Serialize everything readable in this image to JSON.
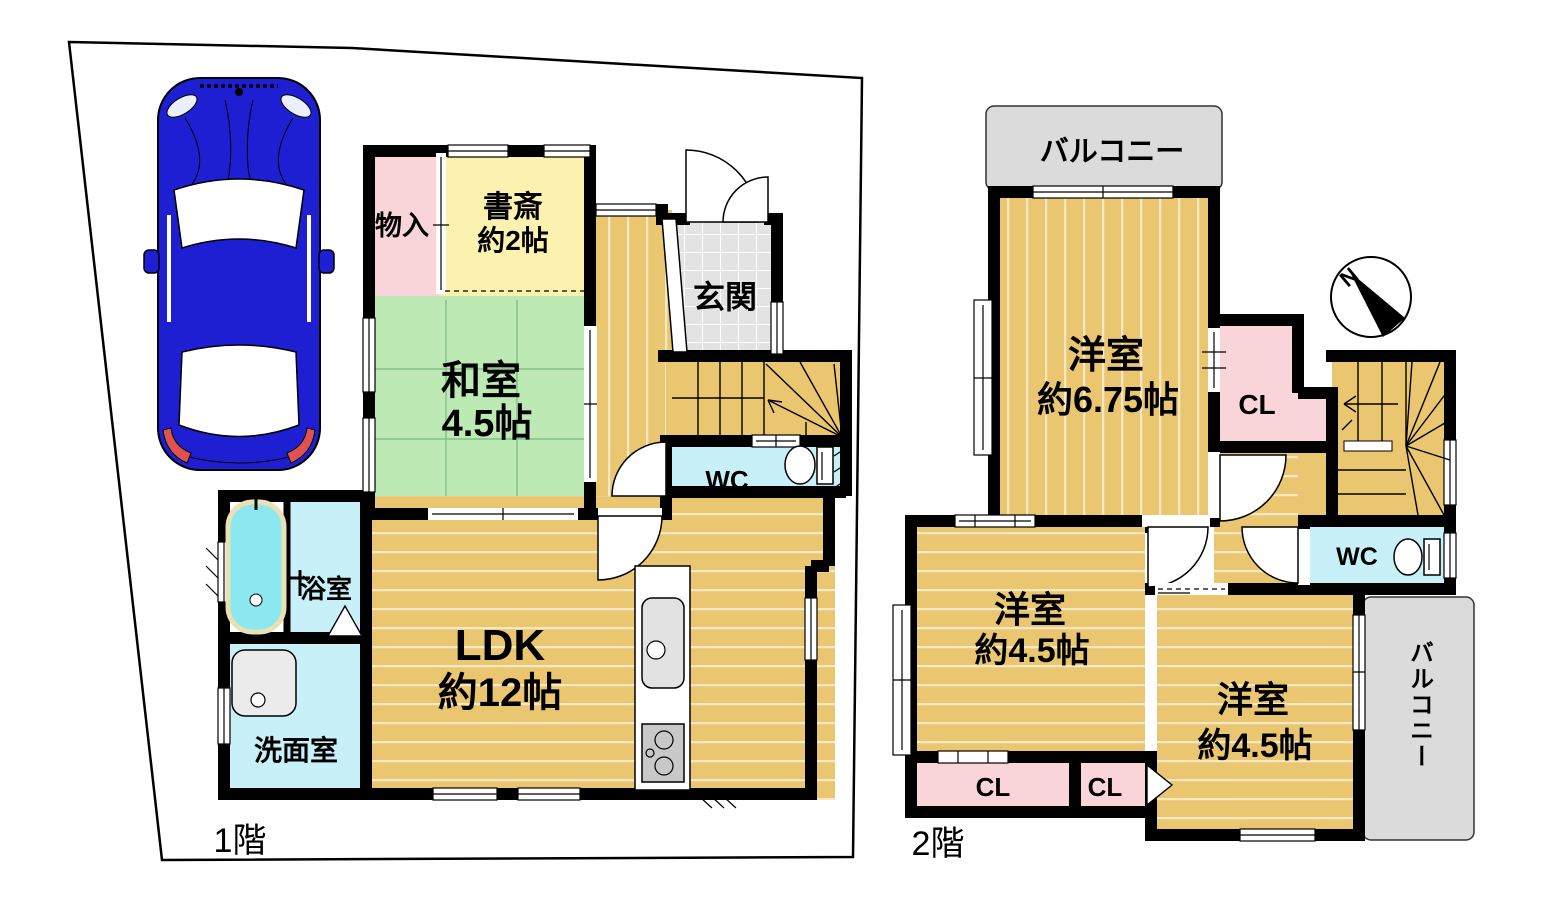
{
  "floor1": {
    "label": "1階",
    "rooms": {
      "storage": "物入",
      "study_name": "書斎",
      "study_size": "約2帖",
      "entrance": "玄関",
      "japanese_room_name": "和室",
      "japanese_room_size": "4.5帖",
      "wc": "WC",
      "bathroom": "浴室",
      "washroom": "洗面室",
      "ldk_name": "LDK",
      "ldk_size": "約12帖"
    }
  },
  "floor2": {
    "label": "2階",
    "rooms": {
      "balcony_top": "バルコニー",
      "western_675_name": "洋室",
      "western_675_size": "約6.75帖",
      "closet_upper": "CL",
      "wc": "WC",
      "western_45_left_name": "洋室",
      "western_45_left_size": "約4.5帖",
      "western_45_right_name": "洋室",
      "western_45_right_size": "約4.5帖",
      "closet_left": "CL",
      "closet_mid": "CL",
      "balcony_right": "バルコニー"
    }
  },
  "compass": {
    "north_label": "N"
  },
  "colors": {
    "wood": "#E9C66F",
    "tatami": "#BCE9B4",
    "study": "#FBF2AF",
    "pink": "#F9D5DA",
    "water": "#C7F0F8",
    "tub": "#8BE7F0",
    "entrance_tile": "#E3E3E3",
    "balcony": "#DBDBDB",
    "car_body": "#1E1ED2",
    "tail_light": "#E0524E"
  }
}
